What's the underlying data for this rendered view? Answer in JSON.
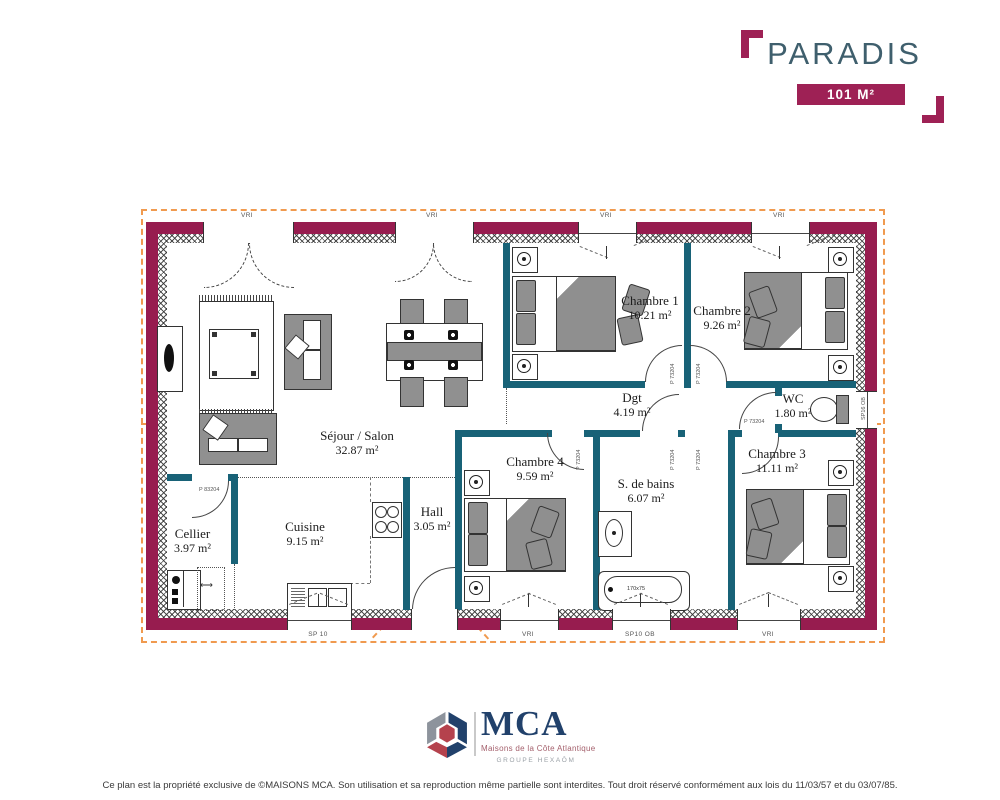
{
  "header": {
    "title": "PARADIS",
    "area_badge": "101 M²"
  },
  "plan": {
    "rooms": [
      {
        "name": "Séjour / Salon",
        "area": "32.87 m²"
      },
      {
        "name": "Cuisine",
        "area": "9.15 m²"
      },
      {
        "name": "Cellier",
        "area": "3.97 m²"
      },
      {
        "name": "Hall",
        "area": "3.05 m²"
      },
      {
        "name": "Chambre 1",
        "area": "10.21 m²"
      },
      {
        "name": "Chambre 2",
        "area": "9.26 m²"
      },
      {
        "name": "Chambre 3",
        "area": "11.11 m²"
      },
      {
        "name": "Chambre 4",
        "area": "9.59 m²"
      },
      {
        "name": "S. de bains",
        "area": "6.07 m²"
      },
      {
        "name": "WC",
        "area": "1.80 m²"
      },
      {
        "name": "Dgt",
        "area": "4.19 m²"
      }
    ],
    "window_labels": {
      "vri": "VRI",
      "sp10": "SP 10",
      "sp10ob": "SP10 OB",
      "sp16ob": "SP16 OB"
    },
    "door_labels": {
      "cellier": "P 83204",
      "standard": "P 73204"
    },
    "fixtures": {
      "bathtub": "170x75"
    }
  },
  "footer": {
    "logo_acronym": "MCA",
    "logo_name": "Maisons de la Côte Atlantique",
    "logo_group": "GROUPE HEXAÔM",
    "copyright": "Ce plan est la propriété exclusive de ©MAISONS MCA. Son utilisation et sa reproduction même partielle sont interdites. Tout droit réservé conformément aux lois du 11/03/57 et du 03/07/85."
  },
  "colors": {
    "exterior_wall": "#971C4F",
    "partition_wall": "#186277",
    "roof_outline": "#F09A4F",
    "accent": "#9E2155",
    "title_text": "#3F5F6D",
    "logo_navy": "#21416B",
    "logo_red": "#B5424D",
    "logo_gray": "#8D939C"
  }
}
